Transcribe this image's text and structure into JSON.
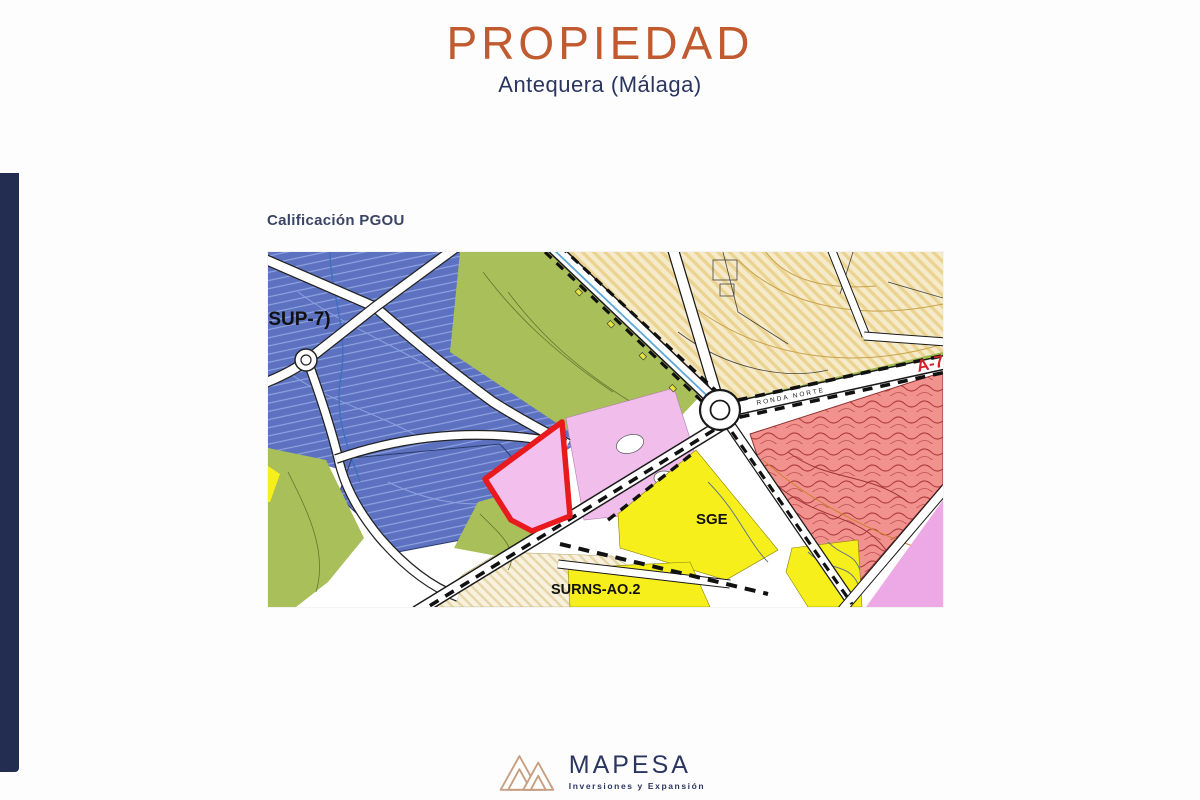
{
  "slide": {
    "title": "PROPIEDAD",
    "subtitle": "Antequera (Málaga)",
    "map_caption": "Calificación PGOU"
  },
  "map": {
    "labels": {
      "sector_left": "(SUP-7)",
      "sge": "SGE",
      "surns": "SURNS-AO.2",
      "road_name": "RONDA NORTE",
      "highway": "A-7"
    },
    "zone_colors": {
      "residential_blue": "#5c72c1",
      "green_zone": "#a8bf5a",
      "rustic_beige": "#f5eaca",
      "facilities_yellow": "#f6ef1c",
      "salmon_sector": "#f1928e",
      "tertiary_pink": "#f1bdeb",
      "property_outline_red": "#e81a1e"
    }
  },
  "footer": {
    "brand": "MAPESA",
    "tagline": "Inversiones y Expansión"
  }
}
